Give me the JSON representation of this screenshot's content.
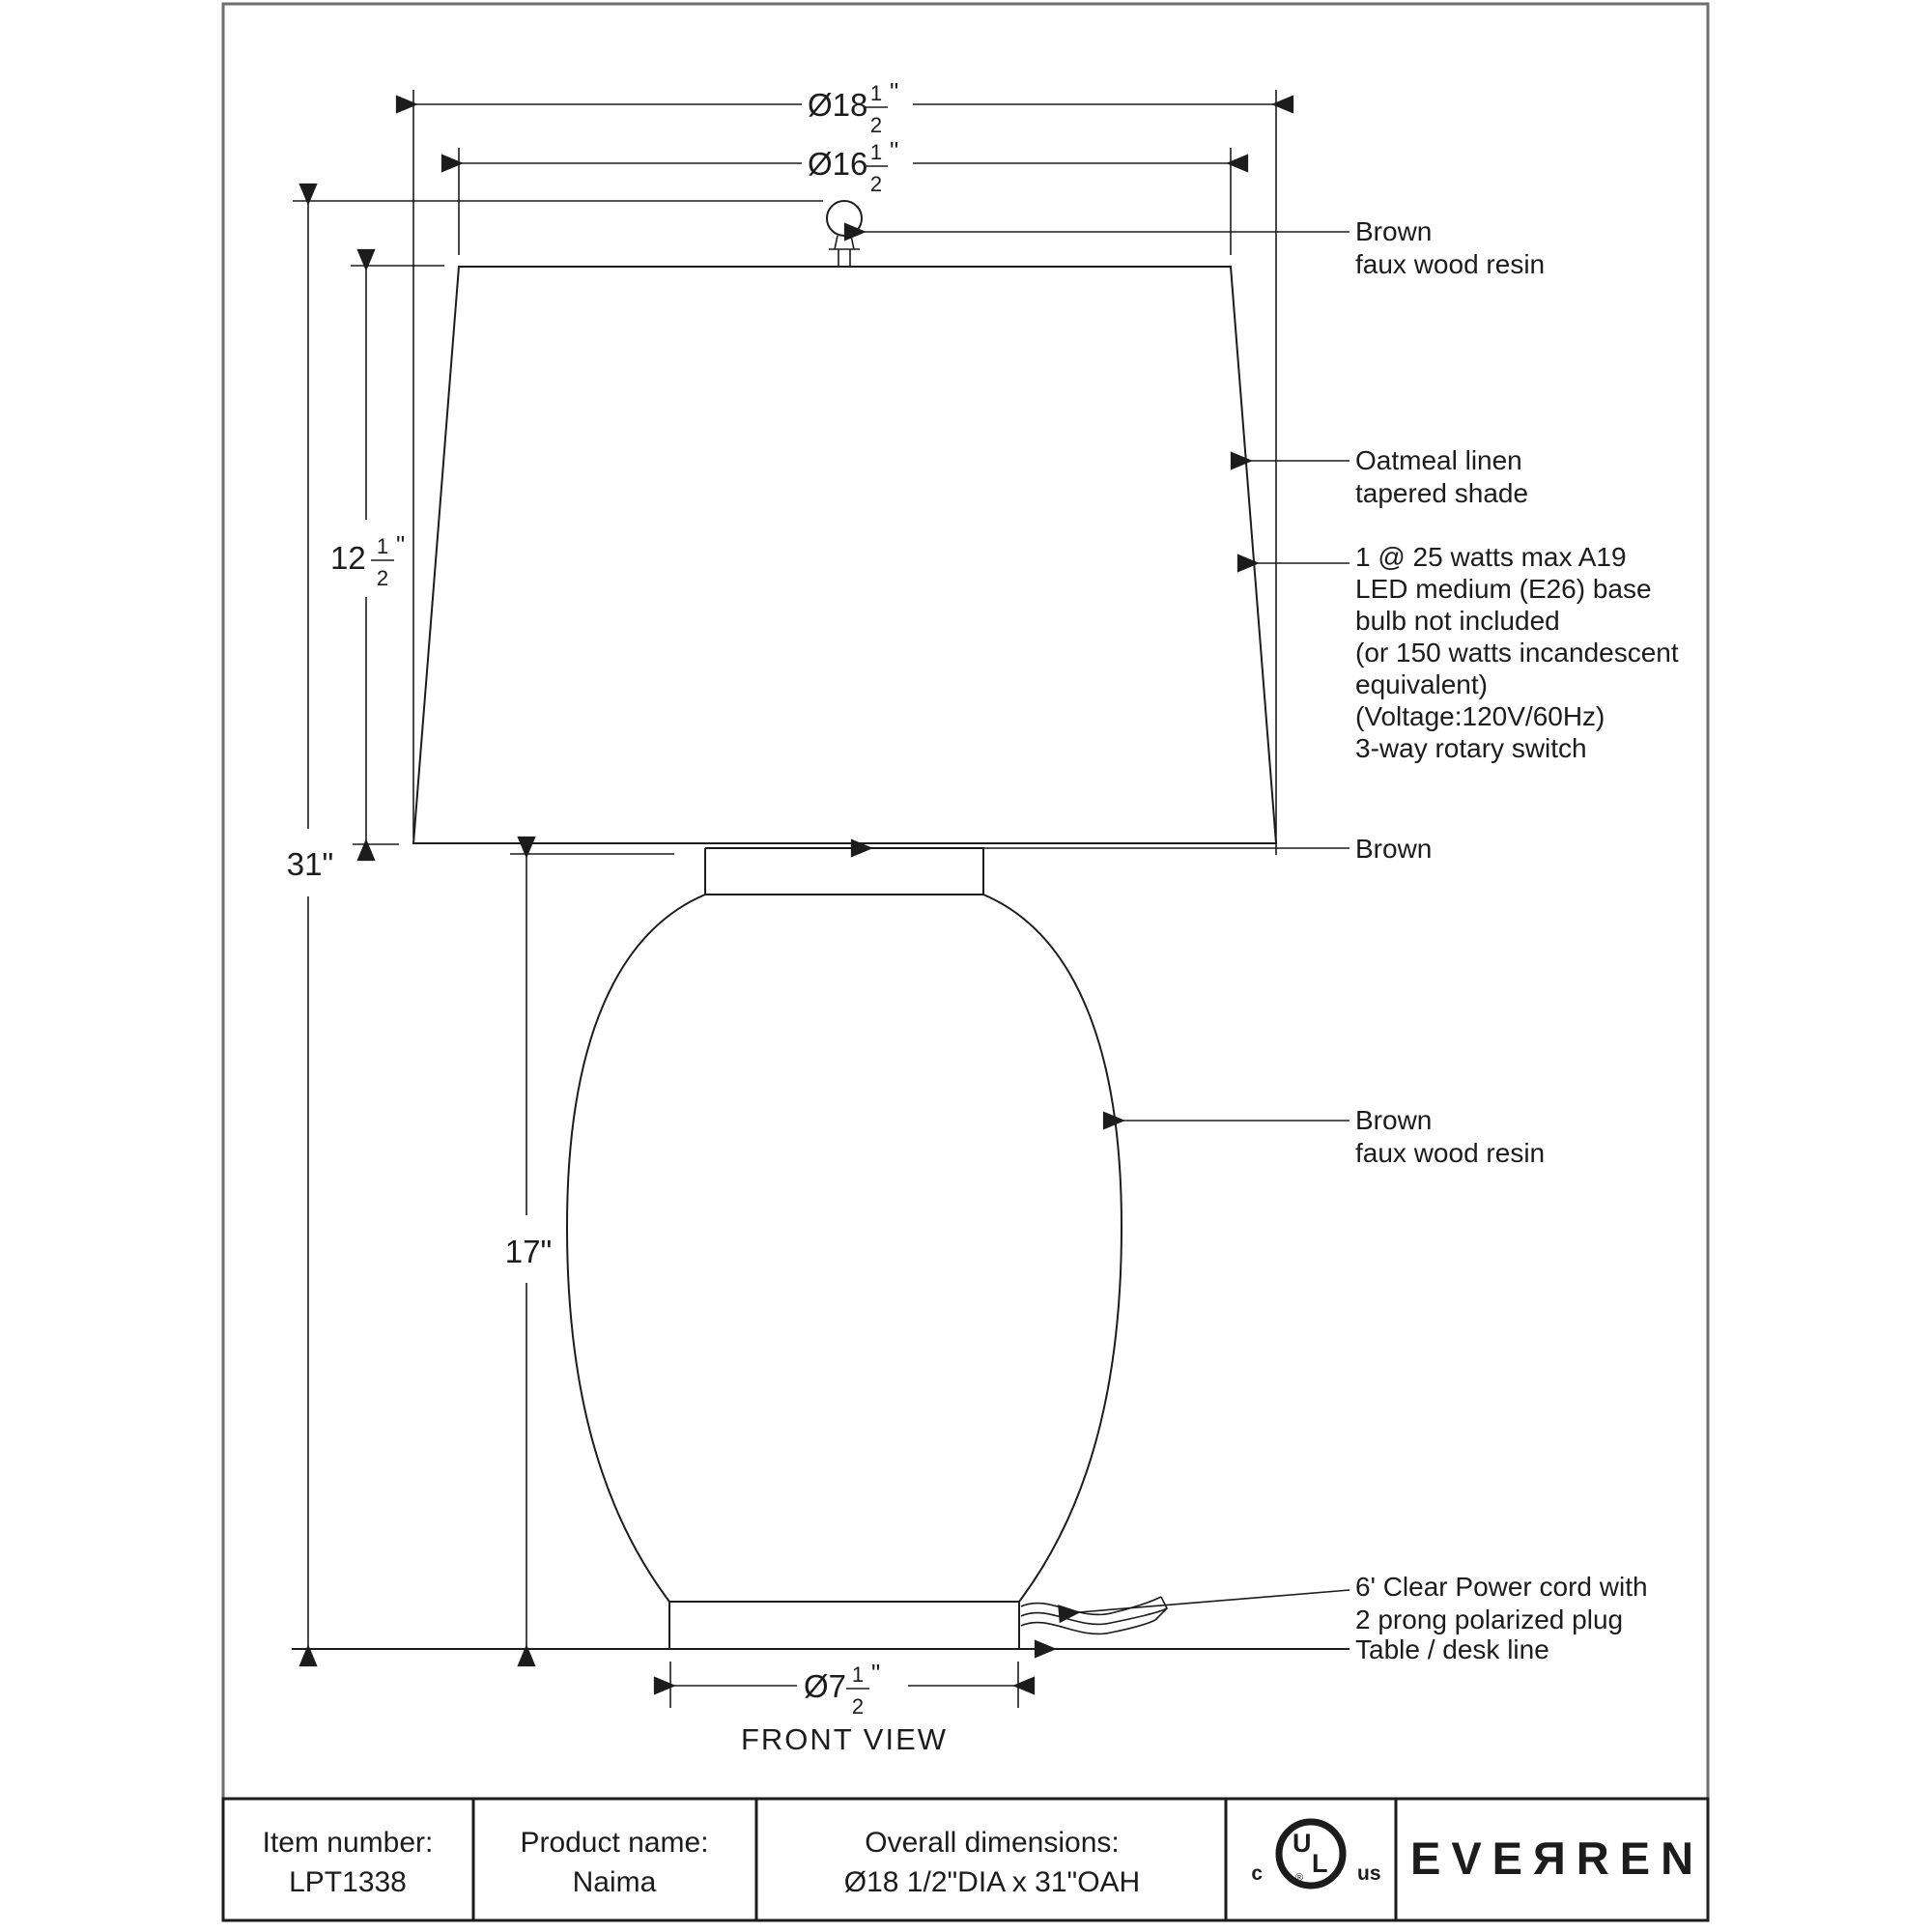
{
  "drawing": {
    "view_label": "FRONT VIEW",
    "dimensions": {
      "overall_height": "31\"",
      "body_height": "17\"",
      "shade_bottom_dia": {
        "prefix": "Ø18",
        "num": "1",
        "den": "2",
        "unit": "\""
      },
      "shade_top_dia": {
        "prefix": "Ø16",
        "num": "1",
        "den": "2",
        "unit": "\""
      },
      "shade_height": {
        "prefix": "12",
        "num": "1",
        "den": "2",
        "unit": "\""
      },
      "base_dia": {
        "prefix": "Ø7",
        "num": "1",
        "den": "2",
        "unit": "\""
      }
    },
    "annotations": {
      "finial": {
        "line1": "Brown",
        "line2": "faux wood resin"
      },
      "shade": {
        "line1": "Oatmeal linen",
        "line2": "tapered shade"
      },
      "bulb": {
        "line1": "1 @ 25 watts max A19",
        "line2": "LED medium (E26) base",
        "line3": "bulb not included",
        "line4": "(or 150 watts incandescent",
        "line5": "equivalent)",
        "line6": "(Voltage:120V/60Hz)",
        "line7": "3-way rotary switch"
      },
      "neck": {
        "line1": "Brown"
      },
      "body": {
        "line1": "Brown",
        "line2": "faux wood resin"
      },
      "cord": {
        "line1": "6' Clear Power cord with",
        "line2": "2 prong polarized plug"
      },
      "table": {
        "line1": "Table / desk line"
      }
    }
  },
  "title_block": {
    "item_number_label": "Item number:",
    "item_number_value": "LPT1338",
    "product_name_label": "Product name:",
    "product_name_value": "Naima",
    "dimensions_label": "Overall dimensions:",
    "dimensions_value": "Ø18 1/2\"DIA x 31\"OAH",
    "certification": {
      "left": "c",
      "right": "us",
      "letter_u": "U",
      "letter_l": "L",
      "registered": "®"
    },
    "brand": "EVEЯREN"
  }
}
